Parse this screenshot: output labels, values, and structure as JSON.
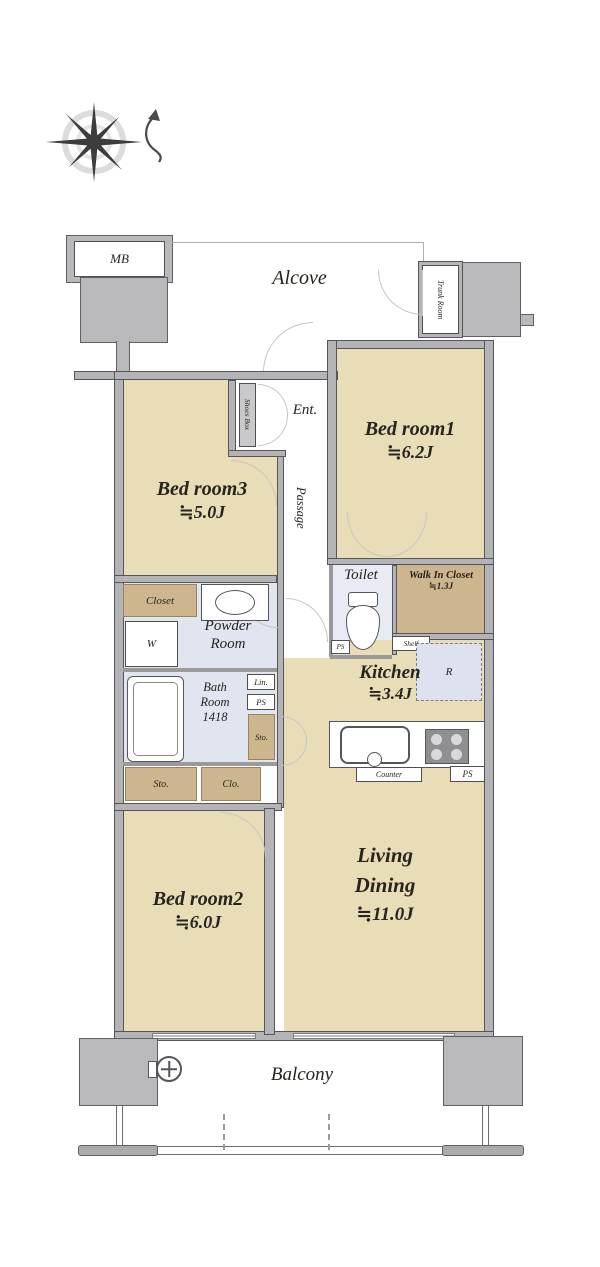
{
  "colors": {
    "floor_beige": "#e9ddb7",
    "storage_tan": "#cdb68e",
    "wet_blue": "#e1e5ef",
    "wall_gray": "#b4b4b6",
    "line_dark": "#55555a",
    "text": "#26241d"
  },
  "exterior": {
    "mb": "MB",
    "alcove": "Alcove",
    "trunk_room": "Trunk Room",
    "balcony": "Balcony"
  },
  "entry": {
    "ent": "Ent.",
    "shoes_box": "Shoes Box",
    "passage": "Passage"
  },
  "rooms": {
    "bedroom1": {
      "name": "Bed room1",
      "area": "≒6.2J"
    },
    "bedroom2": {
      "name": "Bed room2",
      "area": "≒6.0J"
    },
    "bedroom3": {
      "name": "Bed room3",
      "area": "≒5.0J"
    },
    "living": {
      "line1": "Living",
      "line2": "Dining",
      "area": "≒11.0J"
    },
    "kitchen": {
      "name": "Kitchen",
      "area": "≒3.4J"
    },
    "toilet": {
      "name": "Toilet"
    },
    "walk_in_closet": {
      "name": "Walk In Closet",
      "area": "≒1.3J"
    },
    "powder": {
      "line1": "Powder",
      "line2": "Room"
    },
    "bath": {
      "line1": "Bath",
      "line2": "Room",
      "line3": "1418"
    }
  },
  "storage": {
    "closet": "Closet",
    "shelf": "Shelf",
    "sto_hall": "Sto.",
    "sto_row": "Sto.",
    "clo": "Clo.",
    "washer": "W"
  },
  "utility": {
    "lin": "Lin.",
    "ps_toilet": "PS",
    "ps_bath": "PS",
    "ps_kitchen": "PS",
    "counter": "Counter",
    "fridge": "R"
  }
}
